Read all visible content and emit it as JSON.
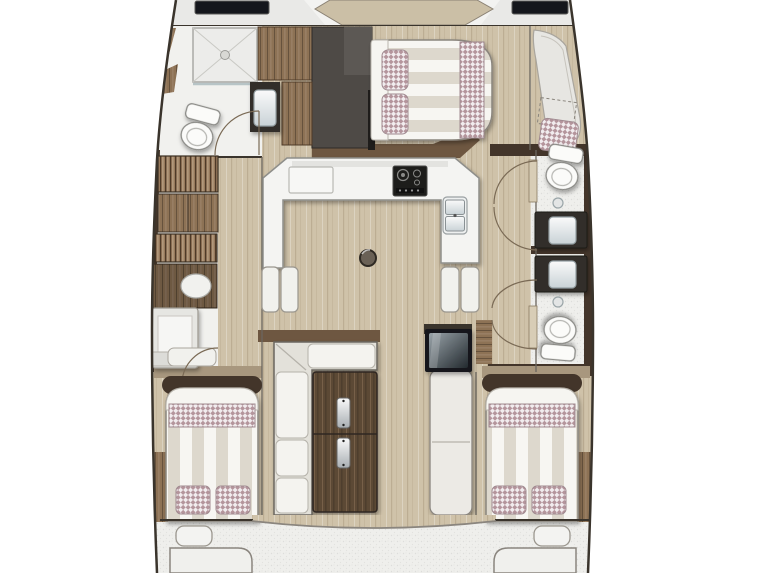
{
  "plan": {
    "regions": [
      {
        "name": "foredeck"
      },
      {
        "name": "forward-port-head"
      },
      {
        "name": "forward-storage"
      },
      {
        "name": "forward-starboard-cabin"
      },
      {
        "name": "starboard-lounge"
      },
      {
        "name": "port-hull-wardrobes"
      },
      {
        "name": "galley"
      },
      {
        "name": "salon"
      },
      {
        "name": "starboard-forward-head"
      },
      {
        "name": "starboard-aft-head"
      },
      {
        "name": "aft-port-cabin"
      },
      {
        "name": "aft-starboard-cabin"
      },
      {
        "name": "cockpit"
      }
    ],
    "fixtures": {
      "deck_hatches": 2,
      "double_berths": 3,
      "toilets": 3,
      "washbasins": 4,
      "showers": 1,
      "stove": 1,
      "galley_sink_basins": 2,
      "companionway_steps": 2,
      "dinette_table_leaves": 2,
      "sofa": 1,
      "bench_seat": 1,
      "cool_box": 1,
      "hanging_lockers": 2,
      "checkered_pillows": 6,
      "checkered_pillow_bands": 3,
      "lounge_cushion": 1,
      "floor_hatch": 1,
      "door_swings": 7,
      "transom_lockers": 2
    }
  },
  "colors": {
    "background": "#ffffff",
    "hull_line": "#3a342c",
    "deck": "#e9e9e7",
    "deck_hatch": "#14161c",
    "deck_seat": "#cbbfa6",
    "floor_wood": "#cfc2a9",
    "floor_white": "#f1f1ee",
    "counter_white": "#f4f4f2",
    "counter_edge": "#8e8e8a",
    "wall_dark_brown": "#43352a",
    "wall_brown": "#6e5741",
    "bulkhead_wood": "#a8977e",
    "cabinet_wood": "#8d7255",
    "cabinet_wood_dark": "#6a523c",
    "storage_gray": "#4e4a46",
    "storage_gray_light": "#5c5854",
    "bath_floor": "#efefec",
    "fixture_white": "#fbfbf9",
    "vanity_dark": "#322e29",
    "stove_black": "#1d1d1b",
    "bed_stripe_a": "#ddd8cd",
    "bed_stripe_b": "#f7f6f2",
    "bed_sheet": "#f6f5f1",
    "pillow_mauve": "#b4959c",
    "pillow_white": "#f1ecee",
    "hanger_base": "#97795c",
    "hanger_line": "#4e3a28",
    "sofa_base": "#e3e1da",
    "cushion_white": "#f4f3ef",
    "table_wood": "#5c4936",
    "table_wood_light": "#77614a",
    "bench_white": "#eceae5",
    "glass_dark": "#232a2f",
    "glass_light": "#9aa4aa",
    "metal_light": "#fafafa",
    "metal_dark": "#a8aeb2",
    "door_arc": "#7a6a55",
    "transom_line": "#8a857e",
    "lounge_gray": "#e7e6e2"
  }
}
